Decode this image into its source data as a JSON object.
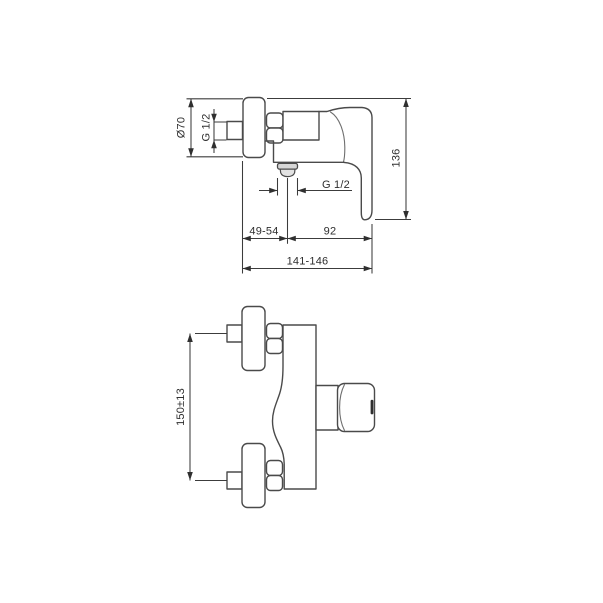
{
  "drawing": {
    "side_view": {
      "labels": {
        "flange_diameter": "Ø70",
        "inlet_thread": "G 1/2",
        "total_height": "136",
        "outlet_thread": "G 1/2",
        "wall_to_outlet": "49-54",
        "outlet_to_front": "92",
        "total_depth": "141-146"
      }
    },
    "plan_view": {
      "labels": {
        "connection_spacing": "150±13"
      }
    },
    "colors": {
      "background": "#ffffff",
      "line": "#4a4a4a",
      "dimension_line": "#3c3c3c",
      "text": "#2e2e2e",
      "outlet_shading": "#d6d6d6",
      "handle_pin": "#2f2f2f"
    }
  }
}
